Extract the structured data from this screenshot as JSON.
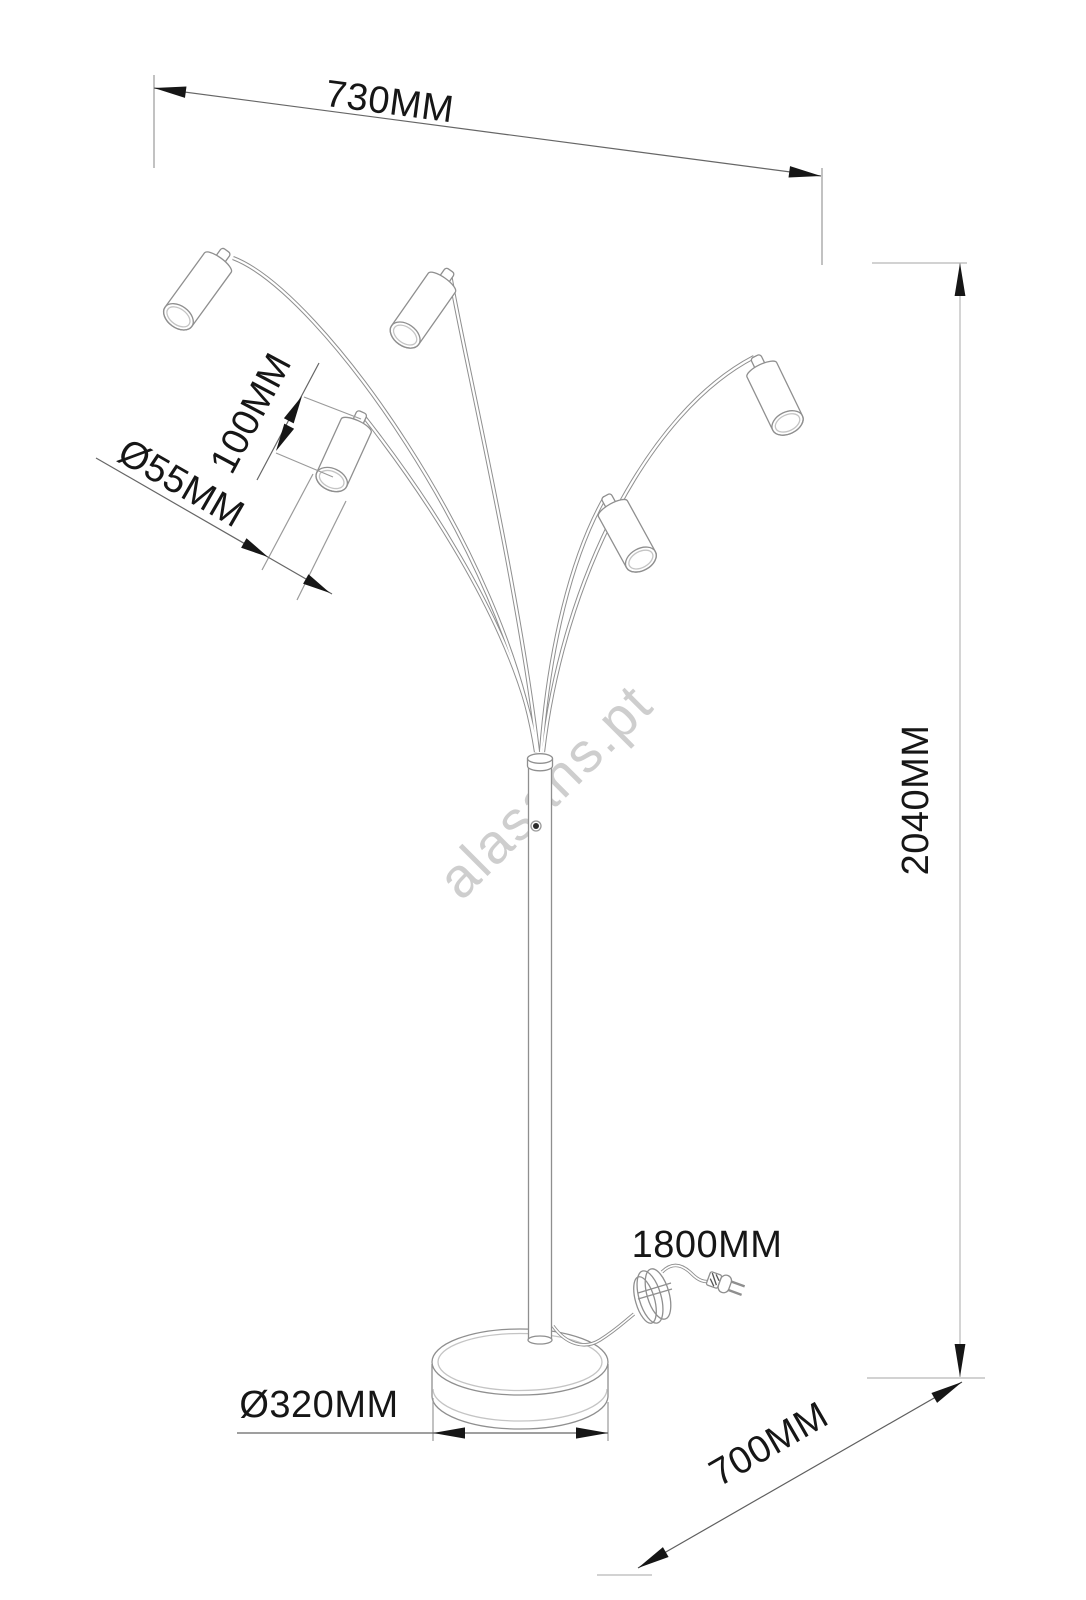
{
  "drawing": {
    "watermark": "alasans.pt",
    "dimensions": {
      "top_width": "730MM",
      "total_height": "2040MM",
      "shade_length": "100MM",
      "shade_diameter": "Ø55MM",
      "base_diameter": "Ø320MM",
      "cable_length": "1800MM",
      "floor_spread": "700MM"
    },
    "colors": {
      "outline_gray": "#8f8f8f",
      "light_gray": "#b7b7b7",
      "dim_line": "#666666",
      "arrow_black": "#161616",
      "watermark_gray": "#c9c9c9"
    }
  }
}
